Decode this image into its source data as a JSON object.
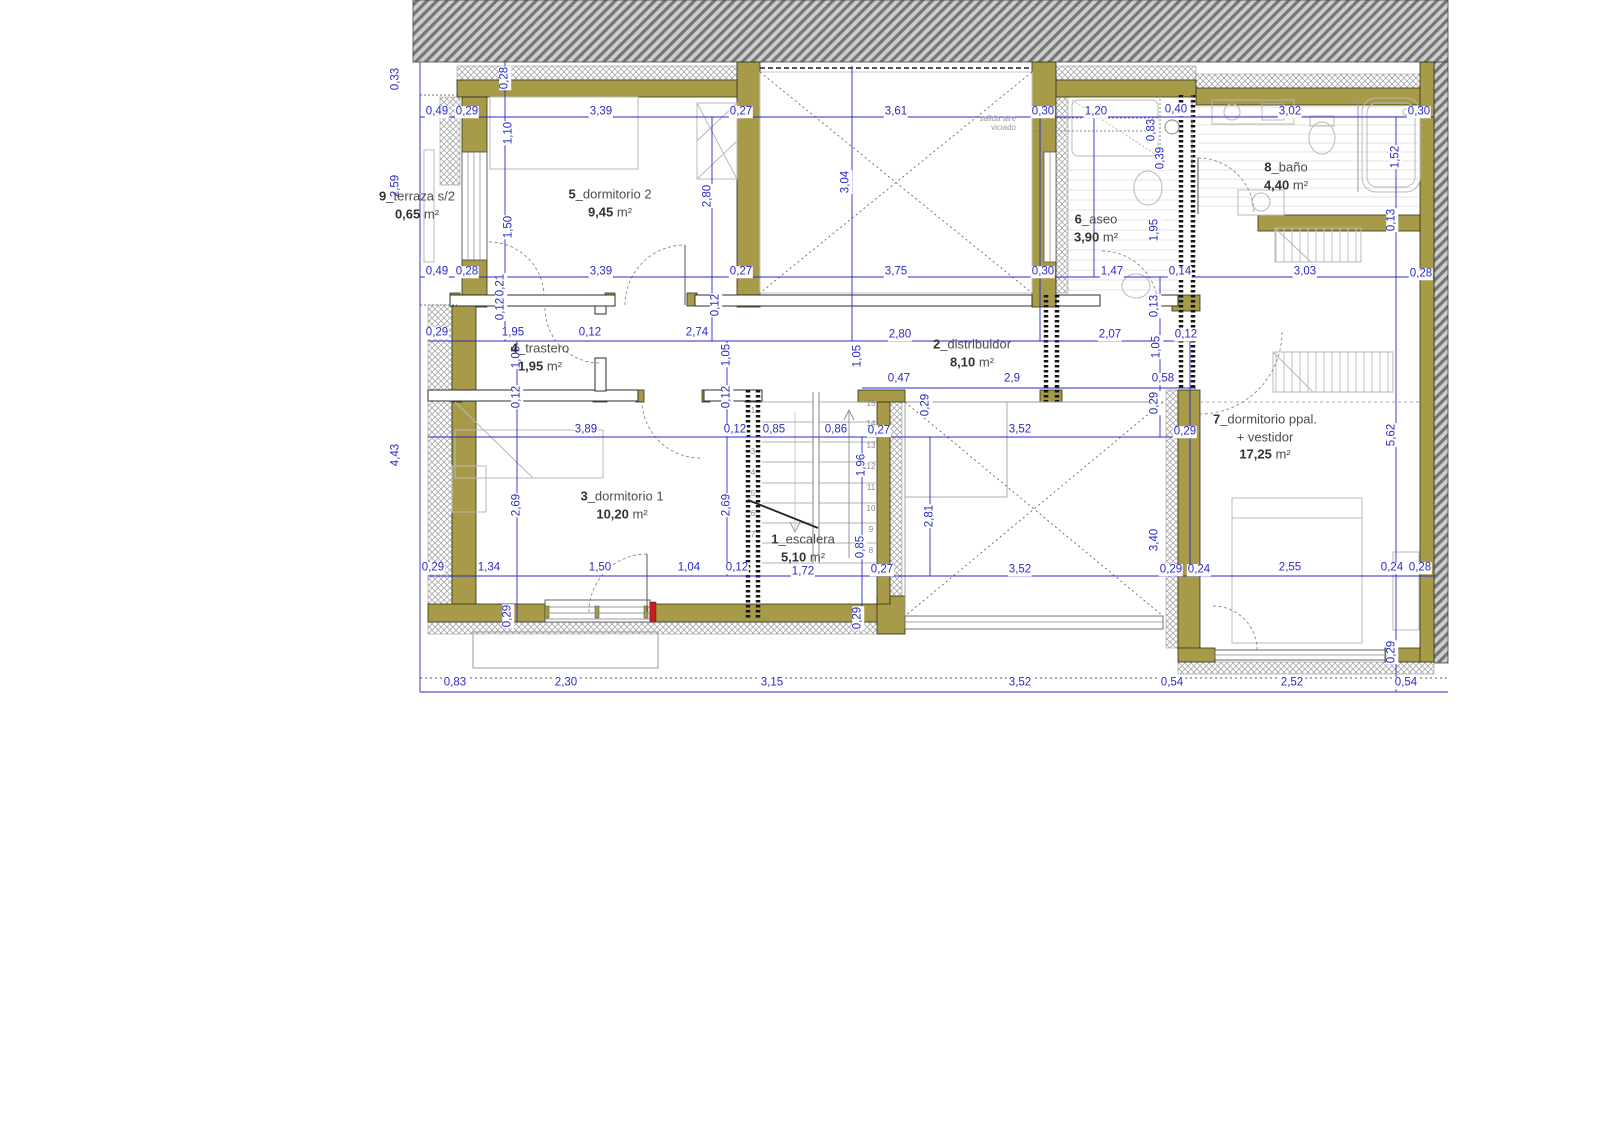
{
  "drawing": {
    "type": "architectural floor plan",
    "language": "es",
    "colors": {
      "dimension_blue": "#2a2ac8",
      "wall_khaki": "#a79b4a",
      "highlight_red": "#c22020"
    }
  },
  "rooms": [
    {
      "key": "terraza",
      "x": 417,
      "y": 205,
      "lines": [
        {
          "b": "9",
          "t": "_terraza s/2"
        },
        {
          "b": "0,65",
          "t": " m²"
        }
      ]
    },
    {
      "key": "dormitorio-2",
      "x": 610,
      "y": 203,
      "lines": [
        {
          "b": "5",
          "t": "_dormitorio 2"
        },
        {
          "b": "9,45",
          "t": " m²"
        }
      ]
    },
    {
      "key": "aseo",
      "x": 1096,
      "y": 228,
      "lines": [
        {
          "b": "6",
          "t": "_aseo"
        },
        {
          "b": "3,90",
          "t": " m²"
        }
      ]
    },
    {
      "key": "bano",
      "x": 1286,
      "y": 176,
      "lines": [
        {
          "b": "8",
          "t": "_baño"
        },
        {
          "b": "4,40",
          "t": " m²"
        }
      ]
    },
    {
      "key": "trastero",
      "x": 540,
      "y": 357,
      "lines": [
        {
          "b": "4",
          "t": "_trastero"
        },
        {
          "b": "1,95",
          "t": " m²"
        }
      ]
    },
    {
      "key": "distribuidor",
      "x": 972,
      "y": 353,
      "lines": [
        {
          "b": "2",
          "t": "_distribuidor"
        },
        {
          "b": "8,10",
          "t": " m²"
        }
      ]
    },
    {
      "key": "dormitorio-1",
      "x": 622,
      "y": 505,
      "lines": [
        {
          "b": "3",
          "t": "_dormitorio 1"
        },
        {
          "b": "10,20",
          "t": " m²"
        }
      ]
    },
    {
      "key": "escalera",
      "x": 803,
      "y": 548,
      "lines": [
        {
          "b": "1",
          "t": "_escalera"
        },
        {
          "b": "5,10",
          "t": " m²"
        }
      ]
    },
    {
      "key": "dormitorio-ppal",
      "x": 1265,
      "y": 437,
      "lines": [
        {
          "b": "7",
          "t": "_dormitorio ppal."
        },
        {
          "b": "",
          "t": "+ vestidor"
        },
        {
          "b": "17,25",
          "t": " m²"
        }
      ]
    }
  ],
  "annotations": [
    {
      "t": "salida aire",
      "x": 1016,
      "y": 119
    },
    {
      "t": "viciado",
      "x": 1016,
      "y": 128
    }
  ],
  "stair_steps": [
    {
      "t": "1",
      "x": 753,
      "y": 411
    },
    {
      "t": "3",
      "x": 753,
      "y": 452
    },
    {
      "t": "4",
      "x": 753,
      "y": 473
    },
    {
      "t": "5",
      "x": 753,
      "y": 494
    },
    {
      "t": "6",
      "x": 753,
      "y": 514
    },
    {
      "t": "7",
      "x": 753,
      "y": 535
    },
    {
      "t": "15",
      "x": 871,
      "y": 404
    },
    {
      "t": "14",
      "x": 871,
      "y": 424
    },
    {
      "t": "13",
      "x": 871,
      "y": 446
    },
    {
      "t": "12",
      "x": 871,
      "y": 467
    },
    {
      "t": "11",
      "x": 871,
      "y": 488
    },
    {
      "t": "10",
      "x": 871,
      "y": 509
    },
    {
      "t": "9",
      "x": 871,
      "y": 530
    },
    {
      "t": "8",
      "x": 871,
      "y": 551
    }
  ],
  "dimensions": [
    {
      "t": "0,49",
      "x": 437,
      "y": 112
    },
    {
      "t": "0,29",
      "x": 467,
      "y": 112
    },
    {
      "t": "3,39",
      "x": 601,
      "y": 112
    },
    {
      "t": "0,27",
      "x": 741,
      "y": 112
    },
    {
      "t": "3,61",
      "x": 896,
      "y": 112
    },
    {
      "t": "0,30",
      "x": 1043,
      "y": 112
    },
    {
      "t": "1,20",
      "x": 1096,
      "y": 112
    },
    {
      "t": "0,40",
      "x": 1176,
      "y": 110
    },
    {
      "t": "3,02",
      "x": 1290,
      "y": 112
    },
    {
      "t": "0,30",
      "x": 1419,
      "y": 112
    },
    {
      "t": "0,49",
      "x": 437,
      "y": 272
    },
    {
      "t": "0,28",
      "x": 467,
      "y": 272
    },
    {
      "t": "3,39",
      "x": 601,
      "y": 272
    },
    {
      "t": "0,27",
      "x": 741,
      "y": 272
    },
    {
      "t": "3,75",
      "x": 896,
      "y": 272
    },
    {
      "t": "0,30",
      "x": 1043,
      "y": 272
    },
    {
      "t": "1,47",
      "x": 1112,
      "y": 272
    },
    {
      "t": "0,14",
      "x": 1180,
      "y": 272
    },
    {
      "t": "3,03",
      "x": 1305,
      "y": 272
    },
    {
      "t": "0,28",
      "x": 1421,
      "y": 274
    },
    {
      "t": "0,29",
      "x": 437,
      "y": 333
    },
    {
      "t": "1,95",
      "x": 513,
      "y": 333
    },
    {
      "t": "0,12",
      "x": 590,
      "y": 333
    },
    {
      "t": "2,74",
      "x": 697,
      "y": 333
    },
    {
      "t": "2,80",
      "x": 900,
      "y": 335
    },
    {
      "t": "2,07",
      "x": 1110,
      "y": 335
    },
    {
      "t": "0,12",
      "x": 1186,
      "y": 335
    },
    {
      "t": "0,47",
      "x": 899,
      "y": 379
    },
    {
      "t": "2,9",
      "x": 1012,
      "y": 379
    },
    {
      "t": "0,58",
      "x": 1163,
      "y": 379
    },
    {
      "t": "3,89",
      "x": 586,
      "y": 430
    },
    {
      "t": "0,12",
      "x": 735,
      "y": 430
    },
    {
      "t": "0,85",
      "x": 774,
      "y": 430
    },
    {
      "t": "0,86",
      "x": 836,
      "y": 430
    },
    {
      "t": "0,27",
      "x": 879,
      "y": 431
    },
    {
      "t": "3,52",
      "x": 1020,
      "y": 430
    },
    {
      "t": "0,29",
      "x": 1185,
      "y": 432
    },
    {
      "t": "0,29",
      "x": 433,
      "y": 568
    },
    {
      "t": "1,34",
      "x": 489,
      "y": 568
    },
    {
      "t": "1,50",
      "x": 600,
      "y": 568
    },
    {
      "t": "1,04",
      "x": 689,
      "y": 568
    },
    {
      "t": "0,12",
      "x": 737,
      "y": 568
    },
    {
      "t": "1,72",
      "x": 803,
      "y": 572
    },
    {
      "t": "0,27",
      "x": 882,
      "y": 570
    },
    {
      "t": "3,52",
      "x": 1020,
      "y": 570
    },
    {
      "t": "0,29",
      "x": 1171,
      "y": 570
    },
    {
      "t": "0,24",
      "x": 1199,
      "y": 570
    },
    {
      "t": "2,55",
      "x": 1290,
      "y": 568
    },
    {
      "t": "0,24",
      "x": 1392,
      "y": 568
    },
    {
      "t": "0,28",
      "x": 1420,
      "y": 568
    },
    {
      "t": "0,83",
      "x": 455,
      "y": 683
    },
    {
      "t": "2,30",
      "x": 566,
      "y": 683
    },
    {
      "t": "3,15",
      "x": 772,
      "y": 683
    },
    {
      "t": "3,52",
      "x": 1020,
      "y": 683
    },
    {
      "t": "0,54",
      "x": 1172,
      "y": 683
    },
    {
      "t": "2,52",
      "x": 1292,
      "y": 683
    },
    {
      "t": "0,54",
      "x": 1406,
      "y": 683
    },
    {
      "t": "0,33",
      "x": 396,
      "y": 79,
      "v": 1
    },
    {
      "t": "2,59",
      "x": 396,
      "y": 186,
      "v": 1
    },
    {
      "t": "4,43",
      "x": 396,
      "y": 455,
      "v": 1
    },
    {
      "t": "0,28",
      "x": 505,
      "y": 78,
      "v": 1
    },
    {
      "t": "1,10",
      "x": 509,
      "y": 133,
      "v": 1
    },
    {
      "t": "1,50",
      "x": 509,
      "y": 227,
      "v": 1
    },
    {
      "t": "0,21",
      "x": 501,
      "y": 285,
      "v": 1
    },
    {
      "t": "0,12",
      "x": 501,
      "y": 309,
      "v": 1
    },
    {
      "t": "2,80",
      "x": 708,
      "y": 196,
      "v": 1
    },
    {
      "t": "0,12",
      "x": 716,
      "y": 305,
      "v": 1
    },
    {
      "t": "3,04",
      "x": 846,
      "y": 182,
      "v": 1
    },
    {
      "t": "1,05",
      "x": 517,
      "y": 357,
      "v": 1
    },
    {
      "t": "0,12",
      "x": 517,
      "y": 397,
      "v": 1
    },
    {
      "t": "2,69",
      "x": 517,
      "y": 505,
      "v": 1
    },
    {
      "t": "0,29",
      "x": 508,
      "y": 616,
      "v": 1
    },
    {
      "t": "1,05",
      "x": 727,
      "y": 355,
      "v": 1
    },
    {
      "t": "0,12",
      "x": 727,
      "y": 397,
      "v": 1
    },
    {
      "t": "2,69",
      "x": 727,
      "y": 505,
      "v": 1
    },
    {
      "t": "1,05",
      "x": 858,
      "y": 356,
      "v": 1
    },
    {
      "t": "0,29",
      "x": 926,
      "y": 405,
      "v": 1
    },
    {
      "t": "1,96",
      "x": 862,
      "y": 465,
      "v": 1
    },
    {
      "t": "0,85",
      "x": 861,
      "y": 547,
      "v": 1
    },
    {
      "t": "0,29",
      "x": 858,
      "y": 618,
      "v": 1
    },
    {
      "t": "2,81",
      "x": 930,
      "y": 516,
      "v": 1
    },
    {
      "t": "0,13",
      "x": 1155,
      "y": 306,
      "v": 1
    },
    {
      "t": "1,05",
      "x": 1157,
      "y": 347,
      "v": 1
    },
    {
      "t": "0,29",
      "x": 1155,
      "y": 403,
      "v": 1
    },
    {
      "t": "3,40",
      "x": 1155,
      "y": 540,
      "v": 1
    },
    {
      "t": "0,83",
      "x": 1152,
      "y": 130,
      "v": 1
    },
    {
      "t": "0,39",
      "x": 1161,
      "y": 158,
      "v": 1
    },
    {
      "t": "1,95",
      "x": 1155,
      "y": 230,
      "v": 1
    },
    {
      "t": "1,52",
      "x": 1396,
      "y": 157,
      "v": 1
    },
    {
      "t": "0,13",
      "x": 1392,
      "y": 220,
      "v": 1
    },
    {
      "t": "5,62",
      "x": 1392,
      "y": 435,
      "v": 1
    },
    {
      "t": "0,29",
      "x": 1392,
      "y": 652,
      "v": 1
    }
  ]
}
